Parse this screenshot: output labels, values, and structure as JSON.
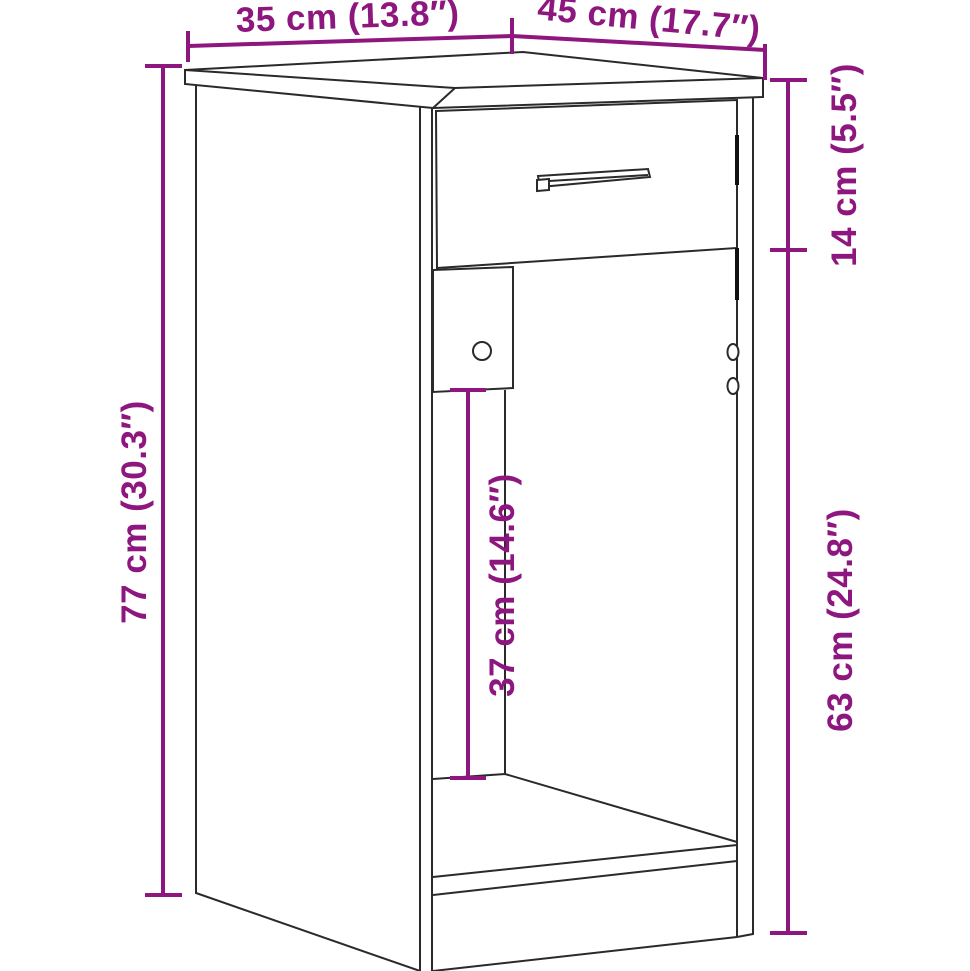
{
  "figure": {
    "kind": "furniture-dimension-diagram",
    "object": "desk cabinet with drawer and open compartment",
    "style": {
      "accent_color": "#8d177e",
      "line_color": "#2a2a2a",
      "background_color": "#ffffff"
    }
  },
  "dims": {
    "d35": {
      "label": "35 cm (13.8″)"
    },
    "d45": {
      "label": "45 cm (17.7″)"
    },
    "d14": {
      "label": "14 cm (5.5″)"
    },
    "d77": {
      "label": "77 cm (30.3″)"
    },
    "d37": {
      "label": "37 cm (14.6″)"
    },
    "d63": {
      "label": "63 cm (24.8″)"
    }
  }
}
